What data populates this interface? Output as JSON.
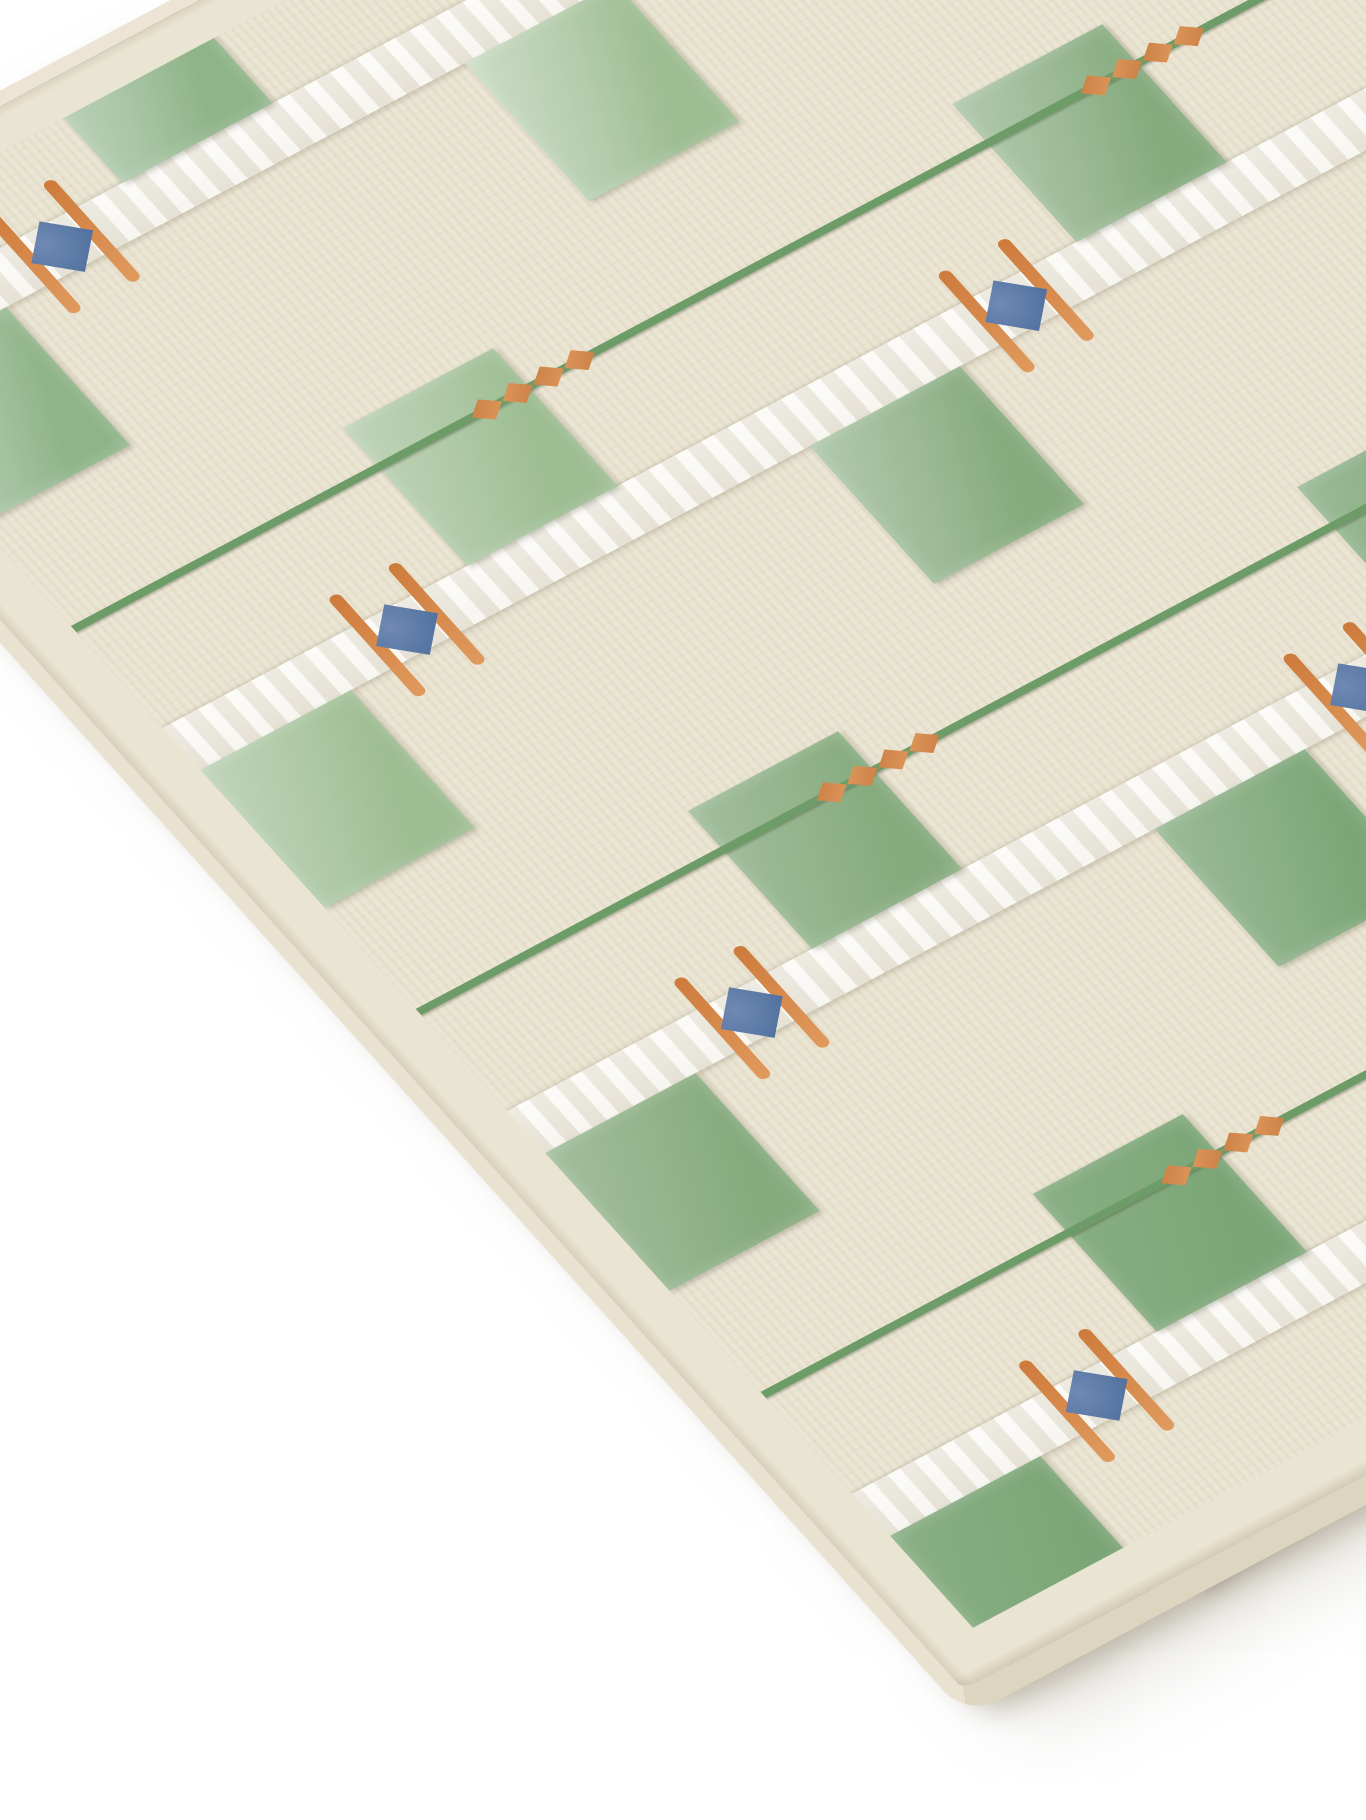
{
  "scene": {
    "type": "product-photo",
    "subject": "hand-tufted plaid area rug shown at an angle on a white backdrop",
    "background_color": "#ffffff"
  },
  "brand_tag": {
    "text": "HATSU",
    "tm_mark": "TM",
    "bg": "#181a2b",
    "fg": "#ffffff"
  },
  "palette": {
    "wool_cream": "#eae4d2",
    "wool_cream_light": "#f2eddd",
    "wool_cream_shadow": "#d9d1b9",
    "silk_band_white": "#f7f6f0",
    "silk_band_shadow": "#dedacd",
    "green_velvet": [
      "#7ca677",
      "#8fb489",
      "#9dbd92",
      "#86ab7e"
    ],
    "green_line": "#6e9c68",
    "copper_diamond": "#c97c42",
    "copper_diamond_light": "#e09a5d",
    "orange_pinstripe": "#cd7b3c",
    "gem_blue": "#51719f",
    "gem_blue_light": "#7189b4",
    "edge_binding": "#e9e2d1",
    "edge_binding_shadow": "#ddd5bf",
    "tag_navy": "#181a2b",
    "tag_text": "#ffffff"
  },
  "motifs": {
    "pattern": "plaid",
    "diamonds_per_chain": 4,
    "gem_shape": "diamond",
    "band_count_visible": 4
  }
}
